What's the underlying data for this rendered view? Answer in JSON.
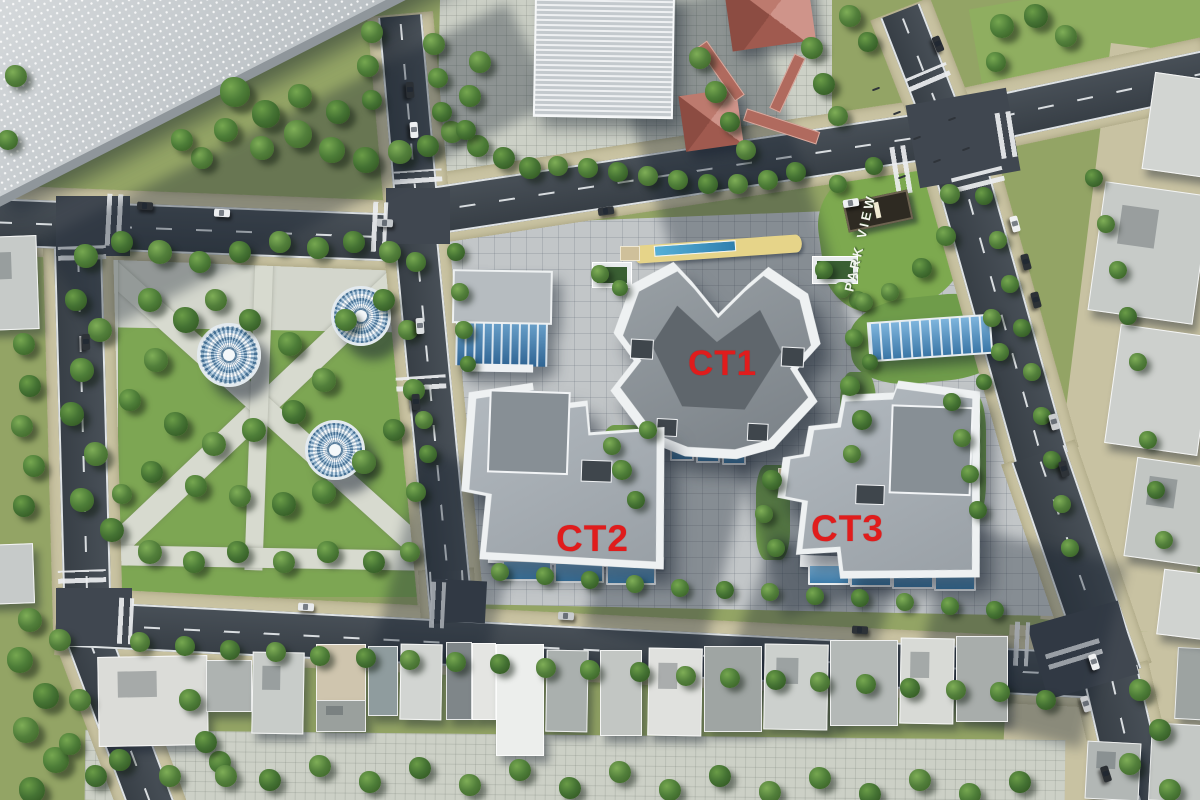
{
  "scene": {
    "kind": "aerial-3d-masterplan-render",
    "site_name": "PARK VIEW residential complex"
  },
  "labels": {
    "ct1": "CT1",
    "ct2": "CT2",
    "ct3": "CT3",
    "park_sign": "PARK VIEW"
  },
  "colors": {
    "label_red": "#e01c1c",
    "grass": "#93a465",
    "tree_green": "#3f6d2f",
    "road_asphalt": "#3e464e",
    "sidewalk_beige": "#c9c3a2",
    "plaza_gray": "#c2c6c8",
    "parapet_white": "#eef1f2",
    "roof_gray": "#8d9499",
    "glass_blue": "#4b8fc4",
    "pagoda_red": "#bd7a6e",
    "podium_yellow": "#e6d489",
    "dome_blue": "#4f7fa4",
    "park_text_white": "#f3f6ee"
  }
}
